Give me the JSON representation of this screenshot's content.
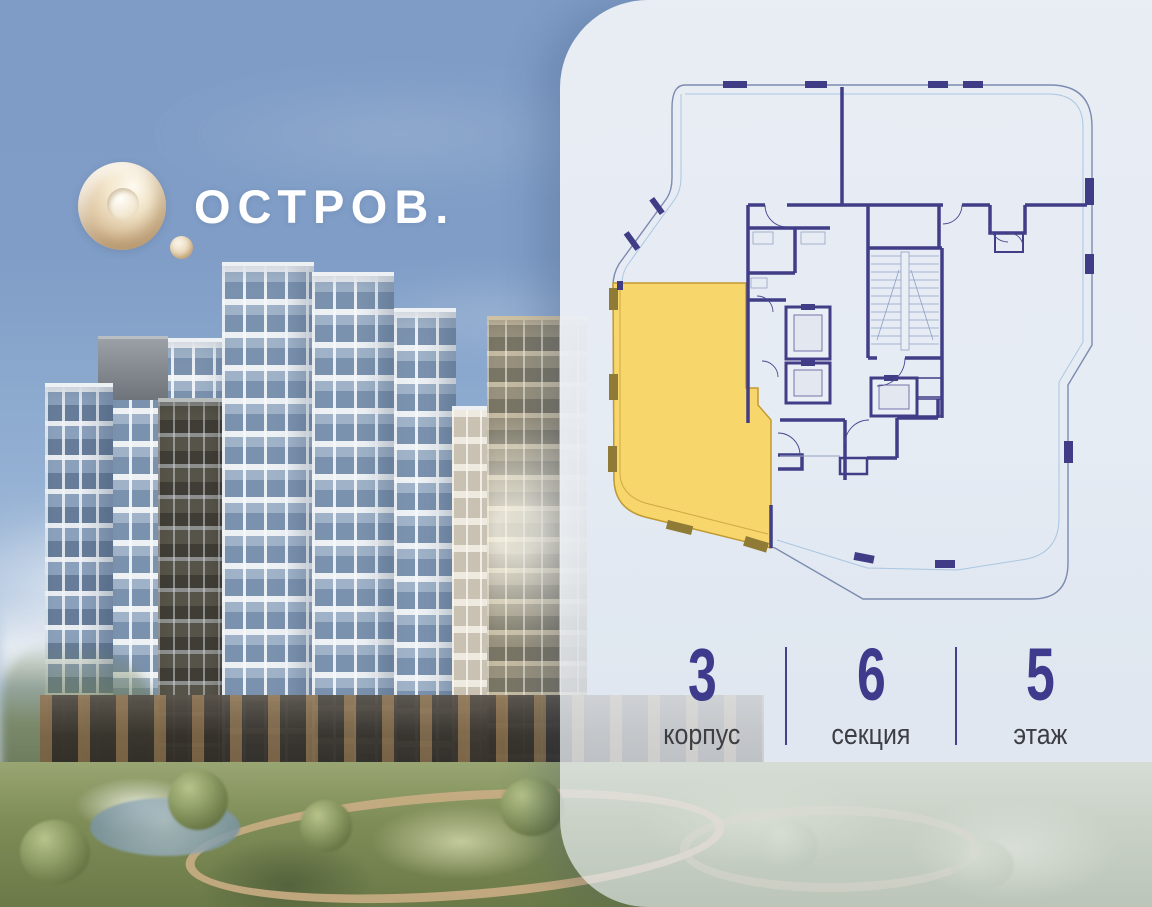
{
  "brand": {
    "name": "ОСТРОВ.",
    "mark": "gold-ring-logo"
  },
  "apartment_info": {
    "items": [
      {
        "value": "3",
        "label": "корпус"
      },
      {
        "value": "6",
        "label": "секция"
      },
      {
        "value": "5",
        "label": "этаж"
      }
    ]
  },
  "floorplan": {
    "description": "floor plan of building section with one apartment highlighted",
    "highlight_color": "#F7D66B",
    "wall_color": "#413D87",
    "facade_line_color": "#7C8BB0",
    "glazing_line_color": "#A9C6E2"
  },
  "colors": {
    "accent_indigo": "#3E3A8C",
    "panel_background": "#ECF0F6",
    "logo_gold": "#DCC4A0",
    "sky": "#7E9CC6",
    "label_gray": "#3D3D44"
  }
}
